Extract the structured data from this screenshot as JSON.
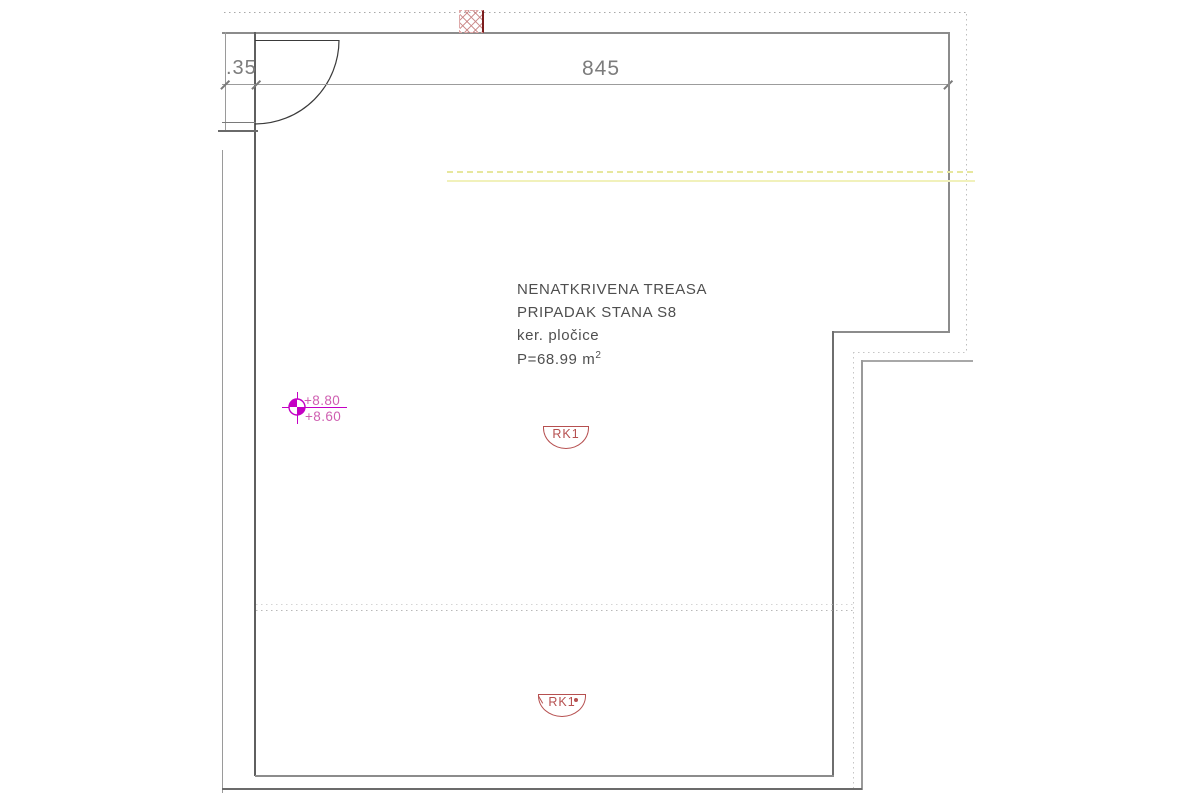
{
  "drawing_type": "architectural-floor-plan-terrace",
  "dimensions": {
    "top_width_label": "845",
    "wall_thickness_label": ".35"
  },
  "room_label": {
    "line1": "NENATKRIVENA TREASA",
    "line2": "PRIPADAK STANA S8",
    "line3": "ker. pločice",
    "area_prefix": "P=68.99 m",
    "area_exponent": "2"
  },
  "elevation_marker": {
    "upper_value": "+8.80",
    "lower_value": "+8.60"
  },
  "drain_symbols": {
    "middle_label": "RK1",
    "bottom_label": "RK1"
  },
  "colors": {
    "wall_gray": "#8c8c8c",
    "wall_dark": "#5f5f5f",
    "dim_gray": "#7c7c7c",
    "text_gray": "#4f4f4f",
    "dotted_gray": "#b4b4b4",
    "yellow_solid": "#f1f1bb",
    "yellow_dashed": "#e7e79e",
    "magenta_symbol": "#c400c4",
    "elevation_text_pink": "#cf5fb1",
    "drain_red": "#b65050",
    "hatch_pink": "#dfa8a8",
    "hatch_dark_red": "#7c1d1d"
  }
}
